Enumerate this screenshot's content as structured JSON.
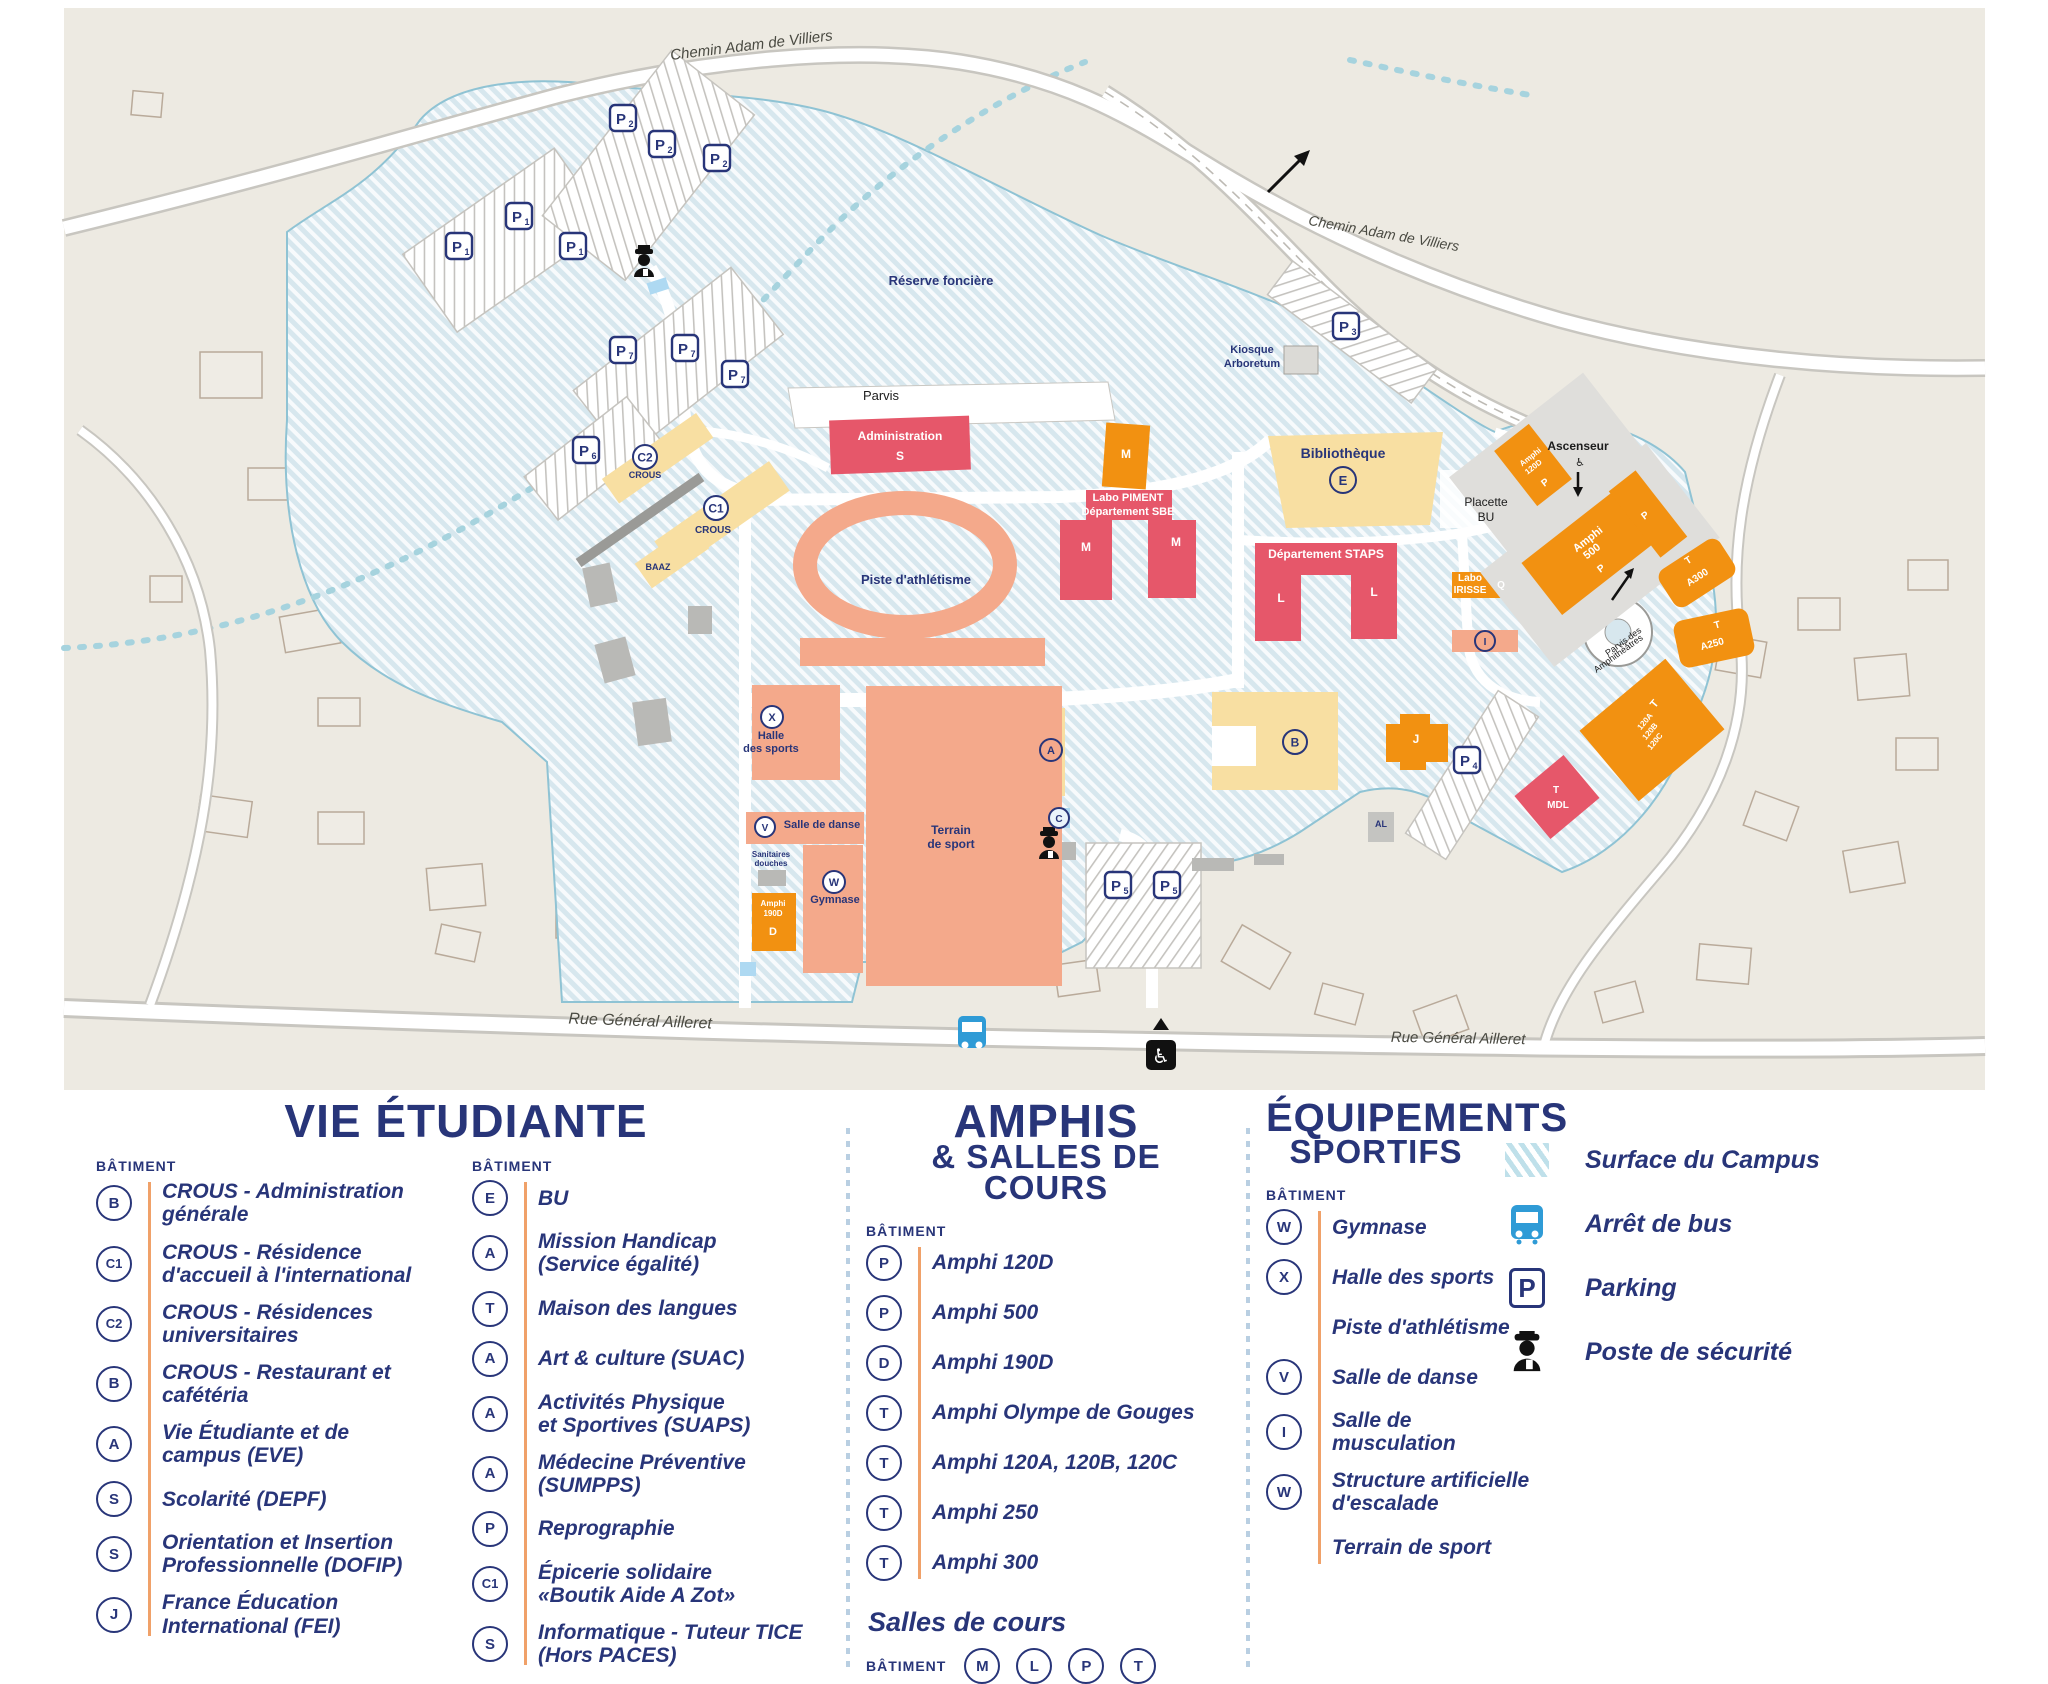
{
  "colors": {
    "navy": "#283579",
    "red": "#e6576a",
    "orange": "#f29111",
    "yellow": "#f8dfa2",
    "salmon": "#f4a98b",
    "hatch_base": "#d7e7ee",
    "bus_blue": "#2f9bd6",
    "accent_line": "#f0a169"
  },
  "map": {
    "texts": [
      {
        "t": "Chemin Adam de Villiers",
        "x": 752,
        "y": 50,
        "s": 15,
        "c": "d",
        "r": -7,
        "i": 1
      },
      {
        "t": "Chemin Adam de Villiers",
        "x": 1383,
        "y": 238,
        "s": 14,
        "c": "d",
        "r": 10,
        "i": 1
      },
      {
        "t": "Rue Général Ailleret",
        "x": 640,
        "y": 1026,
        "s": 16,
        "c": "d",
        "r": 2,
        "i": 1
      },
      {
        "t": "Rue Général Ailleret",
        "x": 1458,
        "y": 1043,
        "s": 15,
        "c": "d",
        "r": 1,
        "i": 1
      },
      {
        "t": "Réserve foncière",
        "x": 941,
        "y": 285,
        "s": 13,
        "c": "n",
        "b": 1
      },
      {
        "t": "Kiosque",
        "x": 1252,
        "y": 353,
        "s": 11,
        "c": "n",
        "b": 1
      },
      {
        "t": "Arboretum",
        "x": 1252,
        "y": 367,
        "s": 11,
        "c": "n",
        "b": 1
      },
      {
        "t": "Parvis",
        "x": 881,
        "y": 400,
        "s": 13,
        "c": "b"
      },
      {
        "t": "Administration",
        "x": 900,
        "y": 440,
        "s": 12,
        "c": "w",
        "b": 1
      },
      {
        "t": "S",
        "x": 900,
        "y": 460,
        "s": 12,
        "c": "w",
        "b": 1
      },
      {
        "t": "M",
        "x": 1126,
        "y": 458,
        "s": 12,
        "c": "w",
        "b": 1
      },
      {
        "t": "Labo PIMENT",
        "x": 1128,
        "y": 501,
        "s": 11,
        "c": "w",
        "b": 1
      },
      {
        "t": "Département SBE",
        "x": 1128,
        "y": 515,
        "s": 11,
        "c": "w",
        "b": 1
      },
      {
        "t": "M",
        "x": 1086,
        "y": 551,
        "s": 12,
        "c": "w",
        "b": 1
      },
      {
        "t": "M",
        "x": 1176,
        "y": 546,
        "s": 12,
        "c": "w",
        "b": 1
      },
      {
        "t": "Piste d'athlétisme",
        "x": 916,
        "y": 584,
        "s": 13,
        "c": "n",
        "b": 1
      },
      {
        "t": "Bibliothèque",
        "x": 1343,
        "y": 458,
        "s": 14,
        "c": "n",
        "b": 1
      },
      {
        "t": "Placette",
        "x": 1486,
        "y": 506,
        "s": 12,
        "c": "b"
      },
      {
        "t": "BU",
        "x": 1486,
        "y": 521,
        "s": 12,
        "c": "b"
      },
      {
        "t": "Ascenseur",
        "x": 1578,
        "y": 450,
        "s": 12,
        "c": "b",
        "b": 1
      },
      {
        "t": "♿",
        "x": 1580,
        "y": 466,
        "s": 11,
        "c": "b"
      },
      {
        "t": "Département STAPS",
        "x": 1326,
        "y": 558,
        "s": 12,
        "c": "w",
        "b": 1
      },
      {
        "t": "L",
        "x": 1281,
        "y": 602,
        "s": 12,
        "c": "w",
        "b": 1
      },
      {
        "t": "L",
        "x": 1374,
        "y": 596,
        "s": 12,
        "c": "w",
        "b": 1
      },
      {
        "t": "Labo",
        "x": 1470,
        "y": 581,
        "s": 10,
        "c": "w",
        "b": 1
      },
      {
        "t": "IRISSE",
        "x": 1470,
        "y": 593,
        "s": 10,
        "c": "w",
        "b": 1
      },
      {
        "t": "Q",
        "x": 1501,
        "y": 588,
        "s": 10,
        "c": "w",
        "b": 1
      },
      {
        "t": "Amphi",
        "x": 1532,
        "y": 459,
        "s": 8,
        "c": "w",
        "b": 1,
        "r": -38
      },
      {
        "t": "120D",
        "x": 1535,
        "y": 469,
        "s": 8,
        "c": "w",
        "b": 1,
        "r": -38
      },
      {
        "t": "P",
        "x": 1547,
        "y": 485,
        "s": 10,
        "c": "w",
        "b": 1,
        "r": -38
      },
      {
        "t": "Amphi",
        "x": 1590,
        "y": 542,
        "s": 11,
        "c": "w",
        "b": 1,
        "r": -38
      },
      {
        "t": "500",
        "x": 1594,
        "y": 554,
        "s": 11,
        "c": "w",
        "b": 1,
        "r": -38
      },
      {
        "t": "P",
        "x": 1603,
        "y": 571,
        "s": 10,
        "c": "w",
        "b": 1,
        "r": -38
      },
      {
        "t": "P",
        "x": 1647,
        "y": 518,
        "s": 10,
        "c": "w",
        "b": 1,
        "r": -38
      },
      {
        "t": "T",
        "x": 1690,
        "y": 563,
        "s": 10,
        "c": "w",
        "b": 1,
        "r": -33
      },
      {
        "t": "A300",
        "x": 1699,
        "y": 580,
        "s": 10,
        "c": "w",
        "b": 1,
        "r": -33
      },
      {
        "t": "T",
        "x": 1718,
        "y": 628,
        "s": 10,
        "c": "w",
        "b": 1,
        "r": -15
      },
      {
        "t": "A250",
        "x": 1713,
        "y": 647,
        "s": 10,
        "c": "w",
        "b": 1,
        "r": -15
      },
      {
        "t": "Parvis des",
        "x": 1625,
        "y": 644,
        "s": 9,
        "c": "b",
        "r": -36
      },
      {
        "t": "Amphithéâtres",
        "x": 1620,
        "y": 656,
        "s": 9,
        "c": "b",
        "r": -36
      },
      {
        "t": "T",
        "x": 1657,
        "y": 706,
        "s": 11,
        "c": "w",
        "b": 1,
        "r": -50
      },
      {
        "t": "120A",
        "x": 1647,
        "y": 723,
        "s": 8,
        "c": "w",
        "b": 1,
        "r": -50
      },
      {
        "t": "120B",
        "x": 1652,
        "y": 733,
        "s": 8,
        "c": "w",
        "b": 1,
        "r": -50
      },
      {
        "t": "120C",
        "x": 1657,
        "y": 743,
        "s": 8,
        "c": "w",
        "b": 1,
        "r": -50
      },
      {
        "t": "T",
        "x": 1556,
        "y": 793,
        "s": 10,
        "c": "w",
        "b": 1
      },
      {
        "t": "MDL",
        "x": 1558,
        "y": 808,
        "s": 10,
        "c": "w",
        "b": 1
      },
      {
        "t": "J",
        "x": 1416,
        "y": 743,
        "s": 12,
        "c": "w",
        "b": 1
      },
      {
        "t": "AL",
        "x": 1381,
        "y": 827,
        "s": 9,
        "c": "n",
        "b": 1
      },
      {
        "t": "CROUS",
        "x": 645,
        "y": 478,
        "s": 9,
        "c": "n",
        "b": 1
      },
      {
        "t": "CROUS",
        "x": 713,
        "y": 533,
        "s": 10,
        "c": "n",
        "b": 1
      },
      {
        "t": "BAAZ",
        "x": 658,
        "y": 570,
        "s": 9,
        "c": "n",
        "b": 1
      },
      {
        "t": "Halle",
        "x": 771,
        "y": 739,
        "s": 11,
        "c": "n",
        "b": 1
      },
      {
        "t": "des sports",
        "x": 771,
        "y": 752,
        "s": 11,
        "c": "n",
        "b": 1
      },
      {
        "t": "Terrain",
        "x": 951,
        "y": 834,
        "s": 12,
        "c": "n",
        "b": 1
      },
      {
        "t": "de sport",
        "x": 951,
        "y": 848,
        "s": 12,
        "c": "n",
        "b": 1
      },
      {
        "t": "Salle de danse",
        "x": 822,
        "y": 828,
        "s": 11,
        "c": "n",
        "b": 1
      },
      {
        "t": "Sanitaires",
        "x": 771,
        "y": 857,
        "s": 8,
        "c": "n",
        "b": 1
      },
      {
        "t": "douches",
        "x": 771,
        "y": 866,
        "s": 8,
        "c": "n",
        "b": 1
      },
      {
        "t": "Amphi",
        "x": 773,
        "y": 906,
        "s": 8,
        "c": "w",
        "b": 1
      },
      {
        "t": "190D",
        "x": 773,
        "y": 916,
        "s": 8,
        "c": "w",
        "b": 1
      },
      {
        "t": "D",
        "x": 773,
        "y": 935,
        "s": 11,
        "c": "w",
        "b": 1
      },
      {
        "t": "Gymnase",
        "x": 835,
        "y": 903,
        "s": 11,
        "c": "n",
        "b": 1
      }
    ],
    "badges": [
      {
        "t": "E",
        "x": 1343,
        "y": 480,
        "r": 13
      },
      {
        "t": "B",
        "x": 1295,
        "y": 742,
        "r": 12
      },
      {
        "t": "A",
        "x": 1051,
        "y": 750,
        "r": 11
      },
      {
        "t": "C",
        "x": 1059,
        "y": 818,
        "r": 10,
        "f": "#eaf4fb"
      },
      {
        "t": "I",
        "x": 1485,
        "y": 641,
        "r": 10
      },
      {
        "t": "C1",
        "x": 716,
        "y": 508,
        "r": 12,
        "f": "#ffffff"
      },
      {
        "t": "C2",
        "x": 645,
        "y": 457,
        "r": 12,
        "f": "#ffffff"
      },
      {
        "t": "X",
        "x": 772,
        "y": 717,
        "r": 11,
        "f": "#ffffff"
      },
      {
        "t": "W",
        "x": 834,
        "y": 882,
        "r": 11,
        "f": "#ffffff"
      },
      {
        "t": "V",
        "x": 765,
        "y": 827,
        "r": 10,
        "f": "#ffffff"
      }
    ],
    "parkings": [
      {
        "sub": "2",
        "x": 623,
        "y": 118
      },
      {
        "sub": "2",
        "x": 662,
        "y": 144
      },
      {
        "sub": "2",
        "x": 717,
        "y": 158
      },
      {
        "sub": "1",
        "x": 519,
        "y": 216
      },
      {
        "sub": "1",
        "x": 459,
        "y": 246
      },
      {
        "sub": "1",
        "x": 573,
        "y": 246
      },
      {
        "sub": "7",
        "x": 623,
        "y": 350
      },
      {
        "sub": "7",
        "x": 685,
        "y": 348
      },
      {
        "sub": "7",
        "x": 735,
        "y": 374
      },
      {
        "sub": "6",
        "x": 586,
        "y": 450
      },
      {
        "sub": "3",
        "x": 1346,
        "y": 326
      },
      {
        "sub": "4",
        "x": 1467,
        "y": 760
      },
      {
        "sub": "5",
        "x": 1118,
        "y": 885
      },
      {
        "sub": "5",
        "x": 1167,
        "y": 885
      }
    ]
  },
  "legend": {
    "vie": {
      "title": "VIE ÉTUDIANTE",
      "batiment": "BÂTIMENT",
      "col1": [
        {
          "b": "B",
          "t": "CROUS - Administration\ngénérale"
        },
        {
          "b": "C1",
          "t": "CROUS - Résidence\nd'accueil à l'international"
        },
        {
          "b": "C2",
          "t": "CROUS - Résidences\nuniversitaires"
        },
        {
          "b": "B",
          "t": "CROUS - Restaurant et\ncafétéria"
        },
        {
          "b": "A",
          "t": "Vie Étudiante et de\ncampus (EVE)"
        },
        {
          "b": "S",
          "t": "Scolarité (DEPF)"
        },
        {
          "b": "S",
          "t": "Orientation et Insertion\nProfessionnelle (DOFIP)"
        },
        {
          "b": "J",
          "t": "France Éducation\nInternational (FEI)"
        }
      ],
      "col2": [
        {
          "b": "E",
          "t": "BU"
        },
        {
          "b": "A",
          "t": "Mission Handicap\n(Service égalité)"
        },
        {
          "b": "T",
          "t": "Maison des langues"
        },
        {
          "b": "A",
          "t": "Art & culture (SUAC)"
        },
        {
          "b": "A",
          "t": "Activités Physique\net Sportives (SUAPS)"
        },
        {
          "b": "A",
          "t": "Médecine Préventive (SUMPPS)"
        },
        {
          "b": "P",
          "t": "Reprographie"
        },
        {
          "b": "C1",
          "t": "Épicerie solidaire\n«Boutik Aide A Zot»"
        },
        {
          "b": "S",
          "t": "Informatique - Tuteur TICE\n(Hors PACES)"
        }
      ]
    },
    "amphis": {
      "title1": "AMPHIS",
      "title2": "& SALLES DE COURS",
      "batiment": "BÂTIMENT",
      "items": [
        {
          "b": "P",
          "t": "Amphi 120D"
        },
        {
          "b": "P",
          "t": "Amphi 500"
        },
        {
          "b": "D",
          "t": "Amphi 190D"
        },
        {
          "b": "T",
          "t": "Amphi Olympe de Gouges"
        },
        {
          "b": "T",
          "t": "Amphi 120A, 120B, 120C"
        },
        {
          "b": "T",
          "t": "Amphi 250"
        },
        {
          "b": "T",
          "t": "Amphi 300"
        }
      ],
      "salles": {
        "heading": "Salles de cours",
        "batiment": "BÂTIMENT",
        "badges": [
          "M",
          "L",
          "P",
          "T"
        ]
      }
    },
    "sport": {
      "title1": "ÉQUIPEMENTS",
      "title2": "SPORTIFS",
      "batiment": "BÂTIMENT",
      "items": [
        {
          "b": "W",
          "t": "Gymnase"
        },
        {
          "b": "X",
          "t": "Halle des sports"
        },
        {
          "b": "",
          "t": "Piste d'athlétisme"
        },
        {
          "b": "V",
          "t": "Salle de danse"
        },
        {
          "b": "I",
          "t": "Salle de\nmusculation"
        },
        {
          "b": "W",
          "t": "Structure artificielle\nd'escalade"
        },
        {
          "b": "",
          "t": "Terrain de sport"
        }
      ]
    },
    "symbols": {
      "items": [
        {
          "icon": "hatch",
          "label": "Surface du Campus"
        },
        {
          "icon": "bus",
          "label": "Arrêt de bus"
        },
        {
          "icon": "parking",
          "label": "Parking"
        },
        {
          "icon": "officer",
          "label": "Poste de sécurité"
        }
      ]
    }
  }
}
